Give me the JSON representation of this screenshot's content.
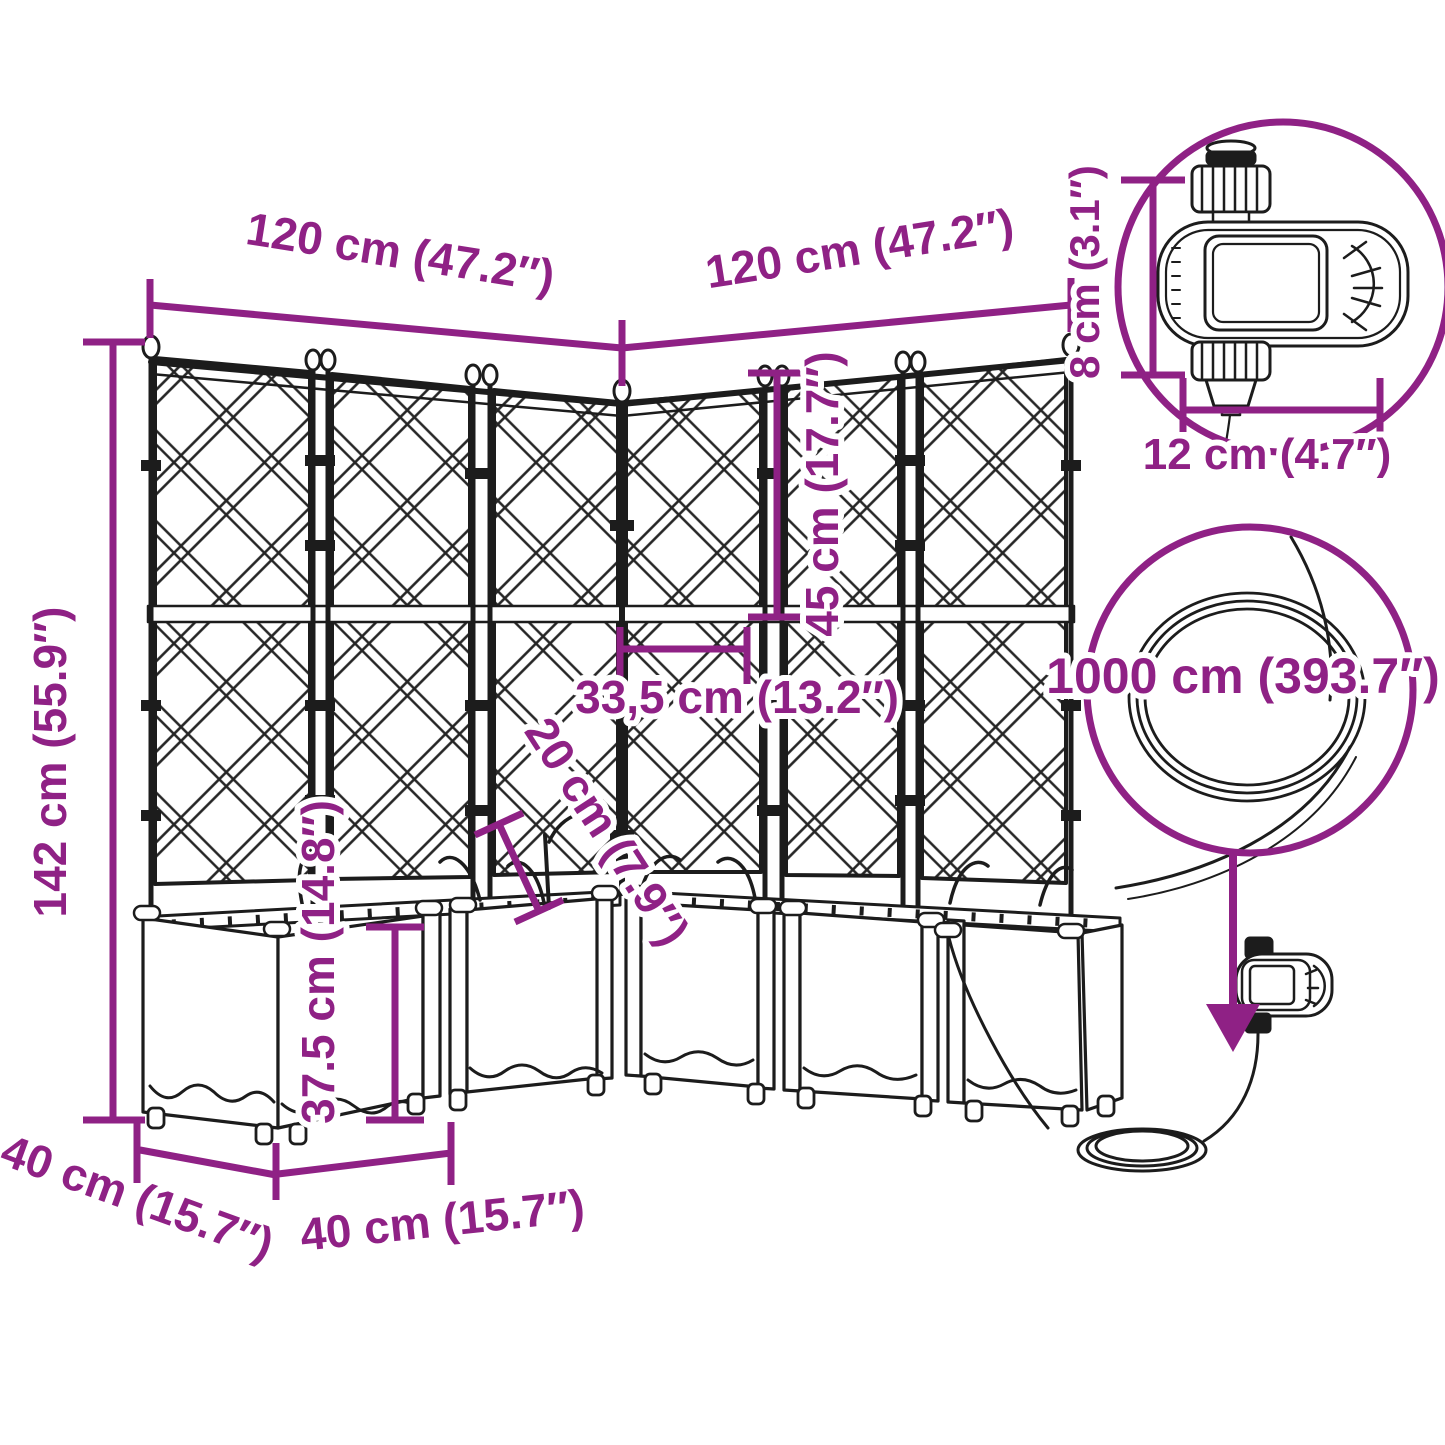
{
  "colors": {
    "accent": "#8f2185",
    "line": "#1c1c1c",
    "background": "#ffffff"
  },
  "diagram": {
    "labels": {
      "width_left": "120 cm (47.2″)",
      "width_right": "120 cm (47.2″)",
      "total_height": "142 cm (55.9″)",
      "trellis_section_height": "45 cm (17.7″)",
      "post_spacing": "33,5 cm (13.2″)",
      "spike_height": "20 cm (7.9″)",
      "planter_height": "37.5 cm (14.8″)",
      "depth_left": "40 cm (15.7″)",
      "depth_right": "40 cm (15.7″)",
      "timer_height": "8 cm (3.1″)",
      "timer_width": "12 cm (4.7″)",
      "hose_length": "1000 cm (393.7″)"
    }
  }
}
